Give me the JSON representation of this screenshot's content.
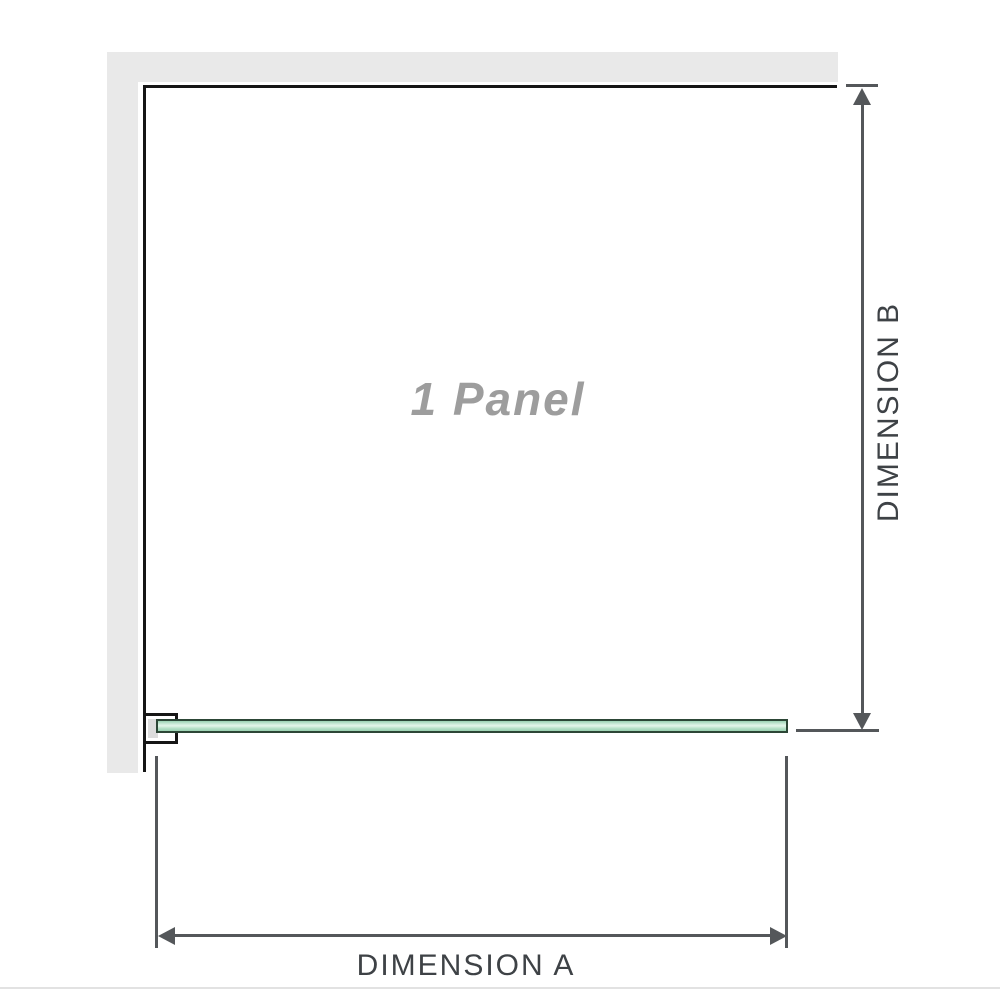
{
  "diagram": {
    "panel_label": "1 Panel",
    "dimension_a_label": "DIMENSION A",
    "dimension_b_label": "DIMENSION B"
  },
  "colors": {
    "wall-gray": "#e9e9e9",
    "anchor-gray": "#dcdcdc",
    "outline-black": "#161616",
    "dim-line": "#54575a",
    "dim-text": "#3e4246",
    "panel-label-gray": "#9d9d9d",
    "glass-outline": "#2c4636",
    "glass-green-dark": "#9bd2b2",
    "glass-green": "#b9e2ca",
    "glass-green-light": "#cdebd9",
    "glass-green-lighter": "#e4f5ea",
    "divider-gray": "#e2e2e2"
  }
}
